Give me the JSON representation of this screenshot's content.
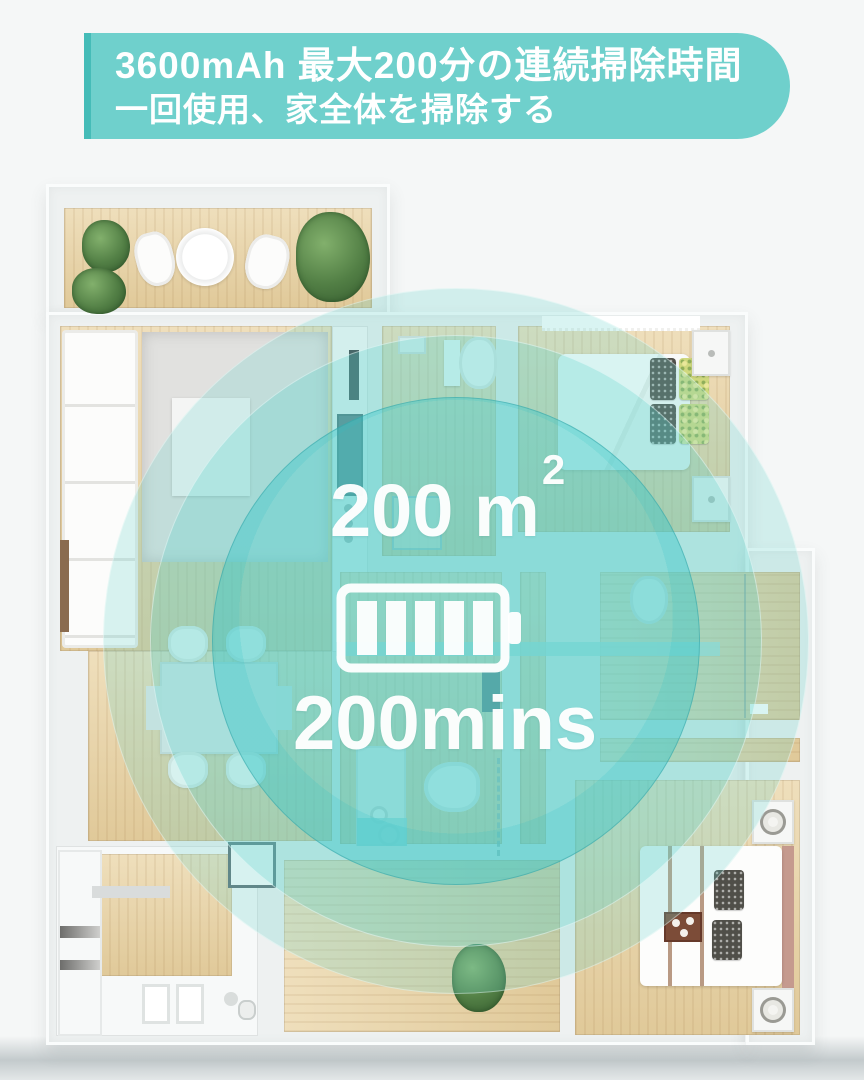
{
  "banner": {
    "line1": "3600mAh 最大200分の連続掃除時間",
    "line2": "一回使用、家全体を掃除する",
    "bg_color": "#6fd0cc",
    "edge_color": "#45bcb8",
    "text_color": "#ffffff"
  },
  "stats": {
    "area_value": "200",
    "area_unit": "m",
    "area_exponent": "2",
    "runtime": "200mins",
    "battery_icon": "battery-icon",
    "battery_segments": 5,
    "text_color": "#ffffff"
  },
  "overlay": {
    "teal_color": "#50cdc9",
    "ring_count": 3
  },
  "floorplan": {
    "wall_color": "#eef1f1",
    "wood_color": "#e9d6ae",
    "background_color": "#f5f7f7",
    "furniture": [
      "potted-plant",
      "round-table",
      "terrace-chair",
      "sofa",
      "rug",
      "coffee-table",
      "tv",
      "kitchen-counter",
      "cooktop",
      "double-bed",
      "pillows",
      "nightstand",
      "lamp",
      "curtain",
      "toilet",
      "bathroom-vanity",
      "shower-glass",
      "bathtub",
      "dining-table",
      "dining-chair",
      "kitchen-sink",
      "serving-tray",
      "sideboard",
      "door"
    ]
  }
}
